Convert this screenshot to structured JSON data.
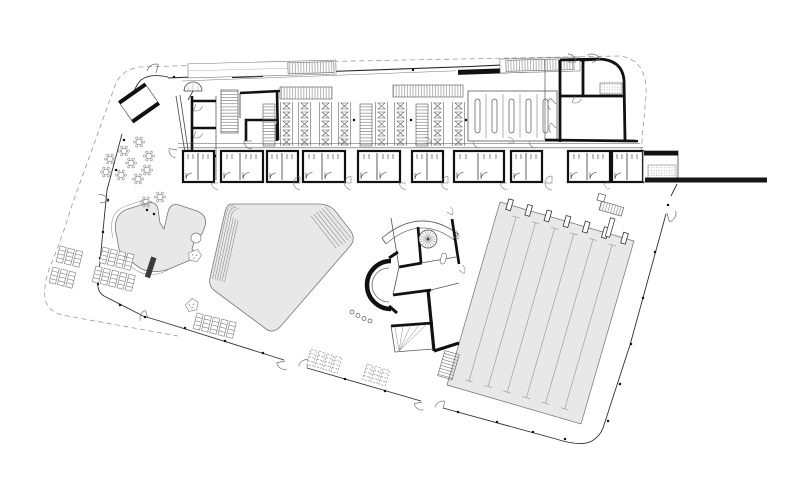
{
  "page": {
    "background": "#ffffff",
    "type": "architectural floor plan",
    "note": "ground-floor plan of a public swimming-pool facility; the drawing contains no text labels"
  },
  "colors": {
    "wall": "#161616",
    "thin_line": "#3a3a3a",
    "light_line": "#8a8a8a",
    "pool_fill": "#e8e8e8",
    "pool_edge": "#777777",
    "lane_line": "#9f9f9f",
    "boundary_dash": "#9a9a9a"
  },
  "plan": {
    "site": {
      "boundary_style": "dashed property line with rounded corners",
      "facade_style": "thin glazed facade line with column dots",
      "facade_column_dots": 27,
      "facade_doors": 6
    },
    "changing_building": {
      "bench_rows": 8,
      "vertical_locker_banks": 3,
      "horizontal_locker_banks": 2,
      "changing_cubicle_slots": 5,
      "shower_wc_blocks": 10,
      "stair_flights": 2,
      "entrance_canopies": 2
    },
    "pools": {
      "lap_pool": {
        "shape": "rotated rectangle",
        "lanes": 7,
        "lane_lines": 6,
        "starting_blocks": 7,
        "fill": "#e8e8e8"
      },
      "main_pool": {
        "shape": "rounded pentagon with step hatching",
        "step_hatch_groups": 2,
        "fill": "#e8e8e8"
      },
      "leisure_pool": {
        "shape": "freeform lagoon",
        "fill": "#e8e8e8"
      }
    },
    "central_block": {
      "spiral_stair_spokes": 14,
      "slide_arc": true,
      "stair_fan": true
    },
    "furniture": {
      "lounger_groups": 7,
      "loungers_total": 27,
      "terrace_tables": 11,
      "entrance_vestibule": 1,
      "parasol_symbol": 1,
      "pool_jetty": 1
    }
  }
}
